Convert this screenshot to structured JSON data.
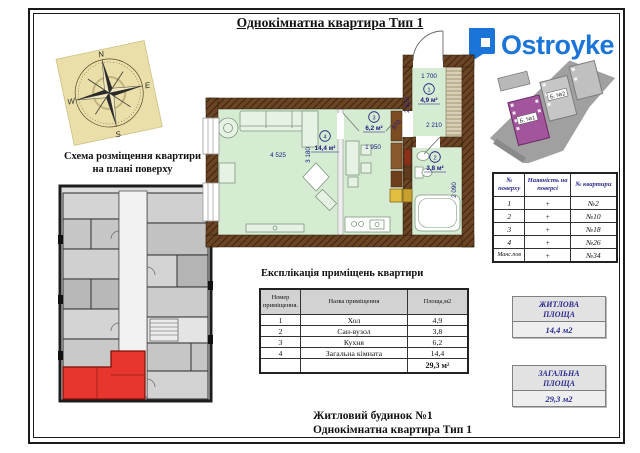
{
  "page": {
    "title": "Однокімнатна квартира Тип 1",
    "footer_line1": "Житловий будинок №1",
    "footer_line2": "Однокімнатна квартира Тип 1"
  },
  "brand": {
    "name": "Ostroyke",
    "color": "#1b74d8"
  },
  "compass": {
    "north": "N",
    "west": "W",
    "south": "S",
    "east": "E"
  },
  "schema_section": {
    "title_line1": "Схема розміщення квартири",
    "title_line2": "на плані поверху"
  },
  "site_map": {
    "building1": "Б. №1",
    "building2": "Б. №2"
  },
  "floors_table": {
    "header_col1": "№ поверху",
    "header_col2": "Наявність на поверсі",
    "header_col3": "№ квартири",
    "rows": [
      [
        "1",
        "+",
        "№2"
      ],
      [
        "2",
        "+",
        "№10"
      ],
      [
        "3",
        "+",
        "№18"
      ],
      [
        "4",
        "+",
        "№26"
      ],
      [
        "Манс.пов",
        "+",
        "№34"
      ]
    ]
  },
  "explication": {
    "title": "Експлікація приміщень квартири",
    "header_col1": "Номер приміщення.",
    "header_col2": "Назва приміщення",
    "header_col3": "Площа,м2",
    "rows": [
      [
        "1",
        "Хол",
        "4,9"
      ],
      [
        "2",
        "Сан-вузол",
        "3,8"
      ],
      [
        "3",
        "Кухня",
        "6,2"
      ],
      [
        "4",
        "Загальна кімната",
        "14,4"
      ]
    ],
    "total": "29,3 м²"
  },
  "badges": [
    {
      "line1": "ЖИТЛОВА",
      "line2": "ПЛОЩА",
      "value": "14,4 м2"
    },
    {
      "line1": "ЗАГАЛЬНА",
      "line2": "ПЛОЩА",
      "value": "29,3 м2"
    }
  ],
  "plan": {
    "rooms": [
      {
        "num": "1",
        "area": "4,9 м²"
      },
      {
        "num": "2",
        "area": "3,8 м²"
      },
      {
        "num": "3",
        "area": "6,2 м²"
      },
      {
        "num": "4",
        "area": "14,4 м²"
      }
    ],
    "dims": {
      "living_width": "4 525",
      "living_depth": "3 180",
      "kitchen_width": "1 950",
      "hall_width": "1 700",
      "hall_depth": "2 620",
      "hall_door": "970",
      "hall_niche": "2 210",
      "bath_depth": "2 090"
    }
  }
}
